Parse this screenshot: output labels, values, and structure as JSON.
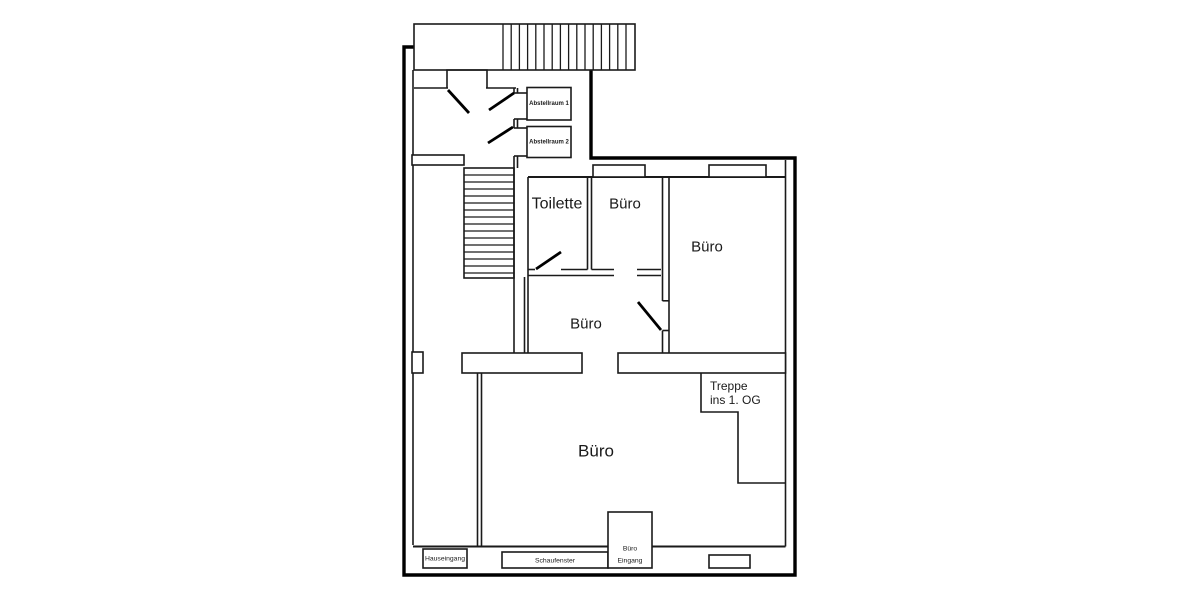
{
  "plan": {
    "rooms": {
      "toilette": {
        "label": "Toilette"
      },
      "buero_klein": {
        "label": "Büro"
      },
      "buero_rechts": {
        "label": "Büro"
      },
      "buero_mitte": {
        "label": "Büro"
      },
      "buero_haupt": {
        "label": "Büro"
      },
      "abstellraum_1": {
        "label": "Abstellraum 1"
      },
      "abstellraum_2": {
        "label": "Abstellraum 2"
      },
      "treppe": {
        "label_line1": "Treppe",
        "label_line2": "ins 1. OG"
      }
    },
    "openings": {
      "hauseingang": {
        "label": "Hauseingang"
      },
      "schaufenster": {
        "label": "Schaufenster"
      },
      "buero_eingang": {
        "label_line1": "Büro",
        "label_line2": "Eingang"
      }
    },
    "colors": {
      "wall": "#000000",
      "background": "#ffffff",
      "door_swing": "#000000"
    }
  }
}
